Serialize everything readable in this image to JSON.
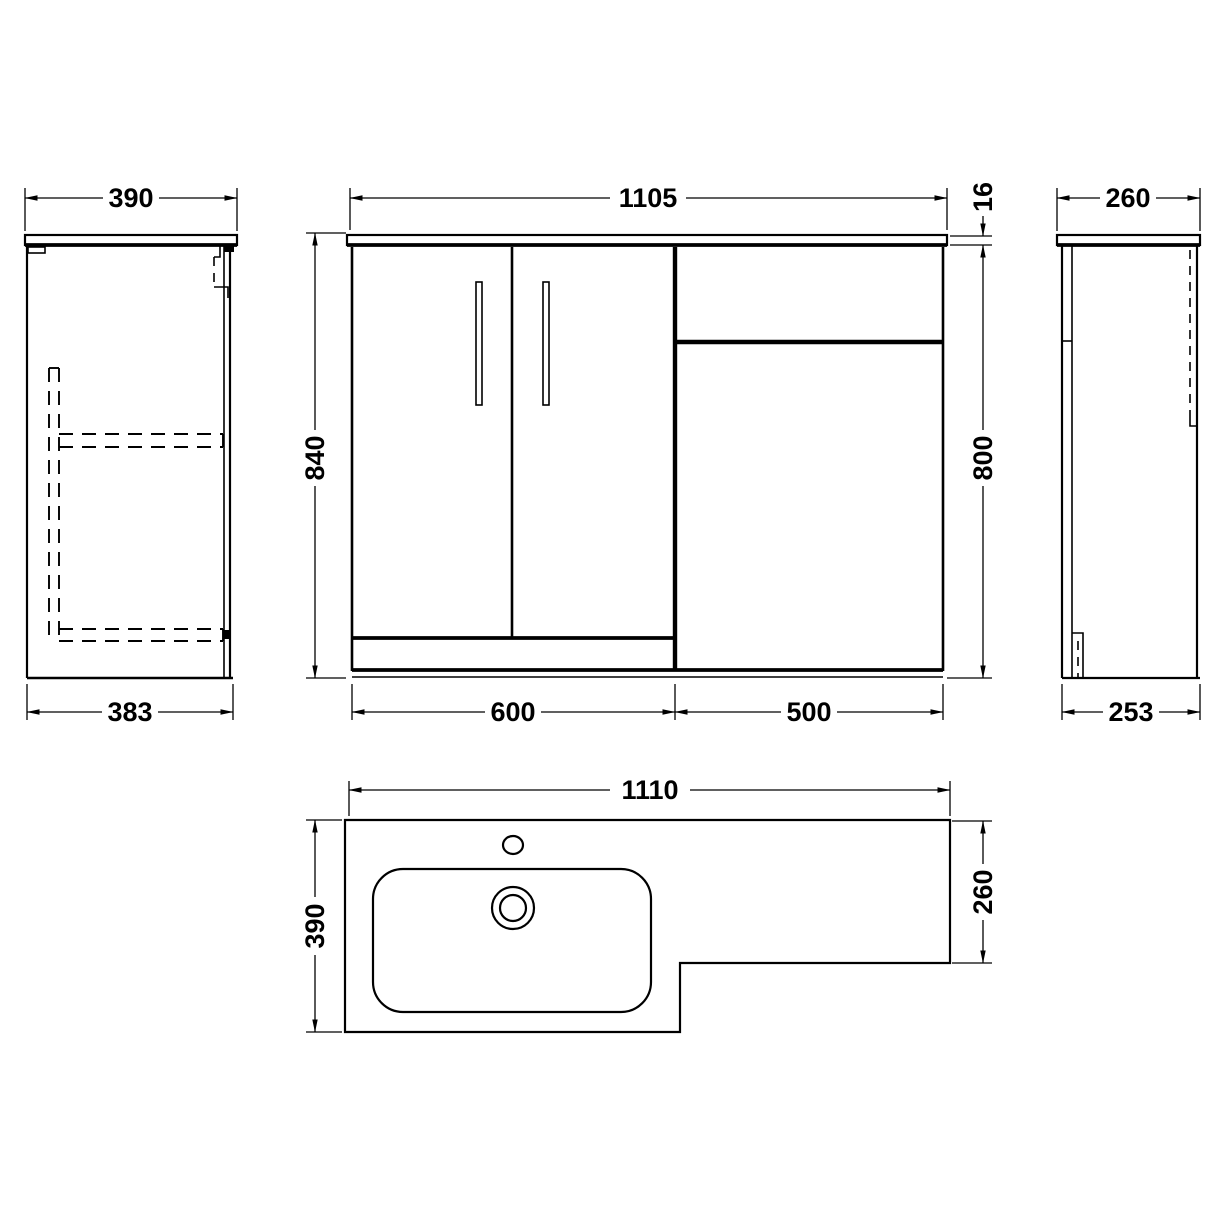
{
  "drawing": {
    "type": "technical-dimension-drawing",
    "subject": "L-shaped bathroom vanity and WC combination unit",
    "background_color": "#ffffff",
    "line_color": "#000000",
    "dimensions": {
      "side_left_width": "390",
      "side_left_base_depth": "383",
      "front_width": "1105",
      "worktop_thickness": "16",
      "front_height_overall": "840",
      "front_height_cabinet": "800",
      "vanity_unit_width": "600",
      "wc_unit_width": "500",
      "side_right_width": "260",
      "side_right_base_depth": "253",
      "plan_width": "1110",
      "plan_depth_full": "390",
      "plan_depth_cistern": "260"
    }
  }
}
